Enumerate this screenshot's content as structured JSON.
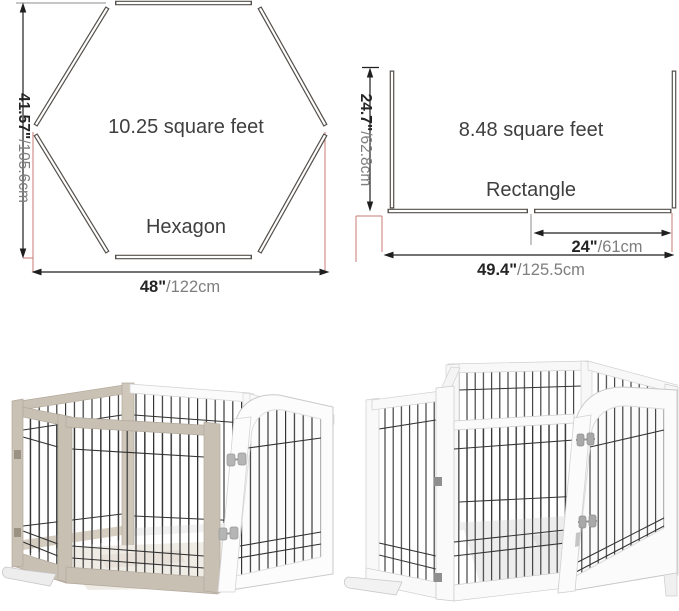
{
  "hex": {
    "area": "10.25 square feet",
    "name": "Hexagon",
    "height_in": "41.57\"",
    "height_cm": "/105.6cm",
    "width_in": "48\"",
    "width_cm": "/122cm"
  },
  "rect": {
    "area": "8.48 square feet",
    "name": "Rectangle",
    "height_in": "24.7\"",
    "height_cm": "/62.8cm",
    "door_in": "24\"",
    "door_cm": "/61cm",
    "width_in": "49.4\"",
    "width_cm": "/125.5cm"
  },
  "colors": {
    "panel_outline": "#55504b",
    "dimension_line": "#1f1f1f",
    "extension_red": "#c97b74",
    "extension_gray": "#8d8d8d",
    "dim_text_primary": "#242424",
    "dim_text_secondary": "#7e7e7e",
    "label_text": "#3f3f3f",
    "pen_frame_greige": "#c9c0b4",
    "pen_frame_white": "#fafafa",
    "wire": "#2e2e2e"
  }
}
